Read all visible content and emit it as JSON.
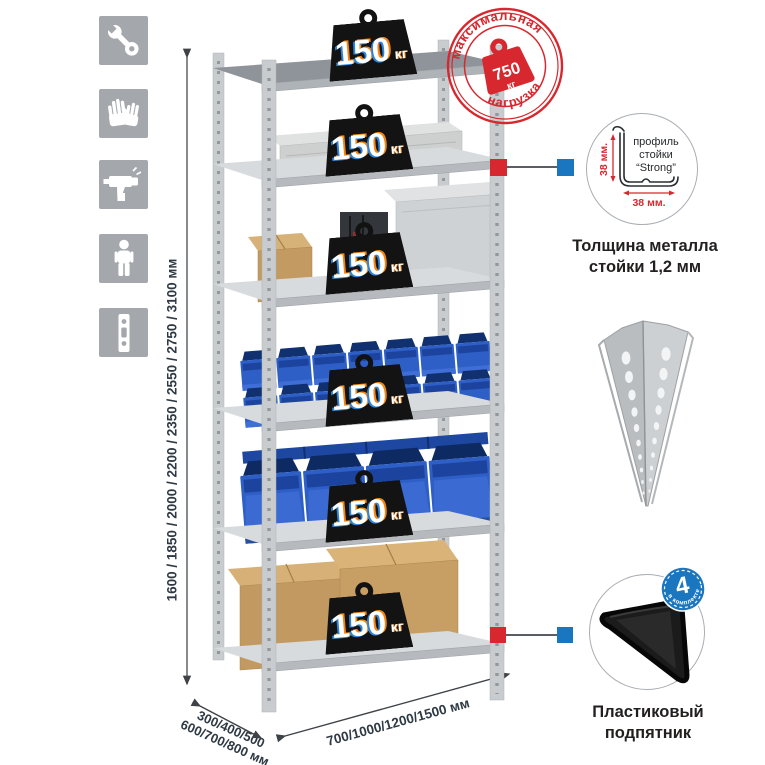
{
  "palette": {
    "red": "#d7282f",
    "blue": "#1b76c0",
    "icon_gray": "#a4a8ac",
    "metal_gray": "#c9ccce",
    "bin_blue": "#2e5fc7",
    "cardboard": "#c49f68",
    "dim_text": "#2e3943"
  },
  "sidebar": {
    "icons": [
      {
        "name": "wrench-icon"
      },
      {
        "name": "gloves-icon"
      },
      {
        "name": "drill-icon"
      },
      {
        "name": "person-icon"
      },
      {
        "name": "perforated-post-icon"
      }
    ]
  },
  "dimensions": {
    "height": "1600 / 1850 / 2000 / 2200 / 2350 / 2550 / 2750 / 3100 мм",
    "depth_line1": "300/400/500",
    "depth_line2": "600/700/800 мм",
    "width": "700/1000/1200/1500 мм"
  },
  "weight_label": {
    "value": "150",
    "unit": "кг"
  },
  "max_load_stamp": {
    "top_arc": "максимальная",
    "bottom_arc": "нагрузка",
    "value": "750",
    "unit": "кг"
  },
  "profile_callout": {
    "line1": "профиль",
    "line2": "стойки",
    "line3": "“Strong”",
    "vertical_dim": "38 мм.",
    "horizontal_dim": "38 мм.",
    "caption_line1": "Толщина металла",
    "caption_line2": "стойки 1,2 мм"
  },
  "foot_callout": {
    "badge_value": "4",
    "badge_arc": "в комплекте",
    "caption_line1": "Пластиковый",
    "caption_line2": "подпятник"
  }
}
